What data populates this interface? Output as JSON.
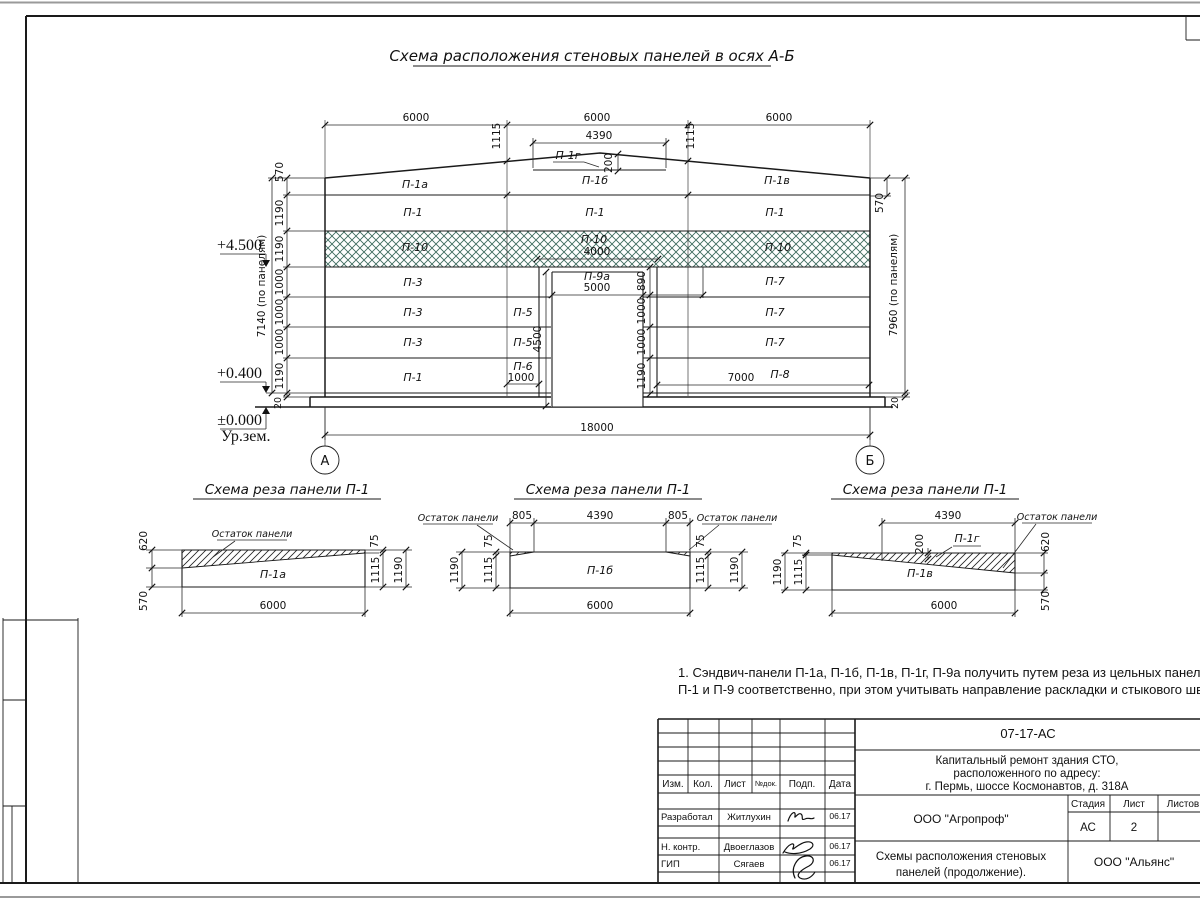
{
  "sheet": {
    "main_title": "Схема расположения стеновых панелей в осях А-Б",
    "note_line1": "1. Сэндвич-панели П-1а, П-1б, П-1в, П-1г, П-9а получить путем реза из цельных панелей",
    "note_line2": "П-1 и П-9 соответственно, при этом учитывать направление раскладки и стыкового шва."
  },
  "elev": {
    "axes": {
      "a": "А",
      "b": "Б"
    },
    "top_dims": [
      "6000",
      "6000",
      "6000"
    ],
    "dim_4390": "4390",
    "dim_1115_l": "1115",
    "dim_1115_r": "1115",
    "dim_200": "200",
    "dim_total": "18000",
    "left_chain": [
      "570",
      "1190",
      "1190",
      "1000",
      "1000",
      "1000",
      "1190",
      "20"
    ],
    "left_total": "7140 (по панелям)",
    "right_570": "570",
    "right_total": "7960 (по панелям)",
    "right_20": "20",
    "door_chain": [
      "890",
      "1000",
      "1000",
      "1190"
    ],
    "dim_4500": "4500",
    "dim_4000": "4000",
    "dim_5000": "5000",
    "dim_1000": "1000",
    "dim_7000": "7000",
    "marks": {
      "m1": "+4.500",
      "m2": "+0.400",
      "m3": "±0.000",
      "ground": "Ур.зем."
    },
    "p_row1": [
      "П-1а",
      "П-1б",
      "П-1в"
    ],
    "p_row2": [
      "П-1",
      "П-1",
      "П-1"
    ],
    "p_row3": [
      "П-10",
      "П-10",
      "П-10"
    ],
    "p_left": [
      "П-3",
      "П-3",
      "П-3",
      "П-1"
    ],
    "p_mid": [
      "П-9а",
      "П-5",
      "П-5",
      "П-6"
    ],
    "p_right": [
      "П-7",
      "П-7",
      "П-7",
      "П-8"
    ],
    "p_ridge": "П-1г"
  },
  "d1": {
    "title": "Схема реза панели П-1",
    "remnant": "Остаток панели",
    "panel": "П-1а",
    "v620": "620",
    "v570": "570",
    "v75": "75",
    "v1115": "1115",
    "v1190": "1190",
    "v6000": "6000"
  },
  "d2": {
    "title": "Схема реза панели П-1",
    "remnant_l": "Остаток панели",
    "remnant_r": "Остаток панели",
    "panel": "П-1б",
    "v805_l": "805",
    "v4390": "4390",
    "v805_r": "805",
    "v75_l": "75",
    "v1115_l": "1115",
    "v1190_l": "1190",
    "v75_r": "75",
    "v1115_r": "1115",
    "v1190_r": "1190",
    "v6000": "6000"
  },
  "d3": {
    "title": "Схема реза панели П-1",
    "remnant": "Остаток панели",
    "panel": "П-1в",
    "piece": "П-1г",
    "v4390": "4390",
    "v200": "200",
    "v75": "75",
    "v1115": "1115",
    "v1190": "1190",
    "v620": "620",
    "v570": "570",
    "v6000": "6000"
  },
  "tb": {
    "doc": "07-17-АС",
    "proj1": "Капитальный ремонт здания СТО,",
    "proj2": "расположенного по адресу:",
    "proj3": "г. Пермь, шоссе Космонавтов, д. 318А",
    "h_izm": "Изм.",
    "h_kol": "Кол.",
    "h_list": "Лист",
    "h_ndok": "№док.",
    "h_podp": "Подп.",
    "h_data": "Дата",
    "r1_role": "Разработал",
    "r1_name": "Житлухин",
    "r1_date": "06.17",
    "r2_role": "Н. контр.",
    "r2_name": "Двоеглазов",
    "r2_date": "06.17",
    "r3_role": "ГИП",
    "r3_name": "Сягаев",
    "r3_date": "06.17",
    "org": "ООО \"Агропроф\"",
    "subj1": "Схемы расположения стеновых",
    "subj2": "панелей (продолжение).",
    "h_stage": "Стадия",
    "h_sheet": "Лист",
    "h_sheets": "Листов",
    "stage": "АС",
    "sheet_no": "2",
    "org2": "ООО \"Альянс\"",
    "hatch_color": "#3E6B5E"
  }
}
